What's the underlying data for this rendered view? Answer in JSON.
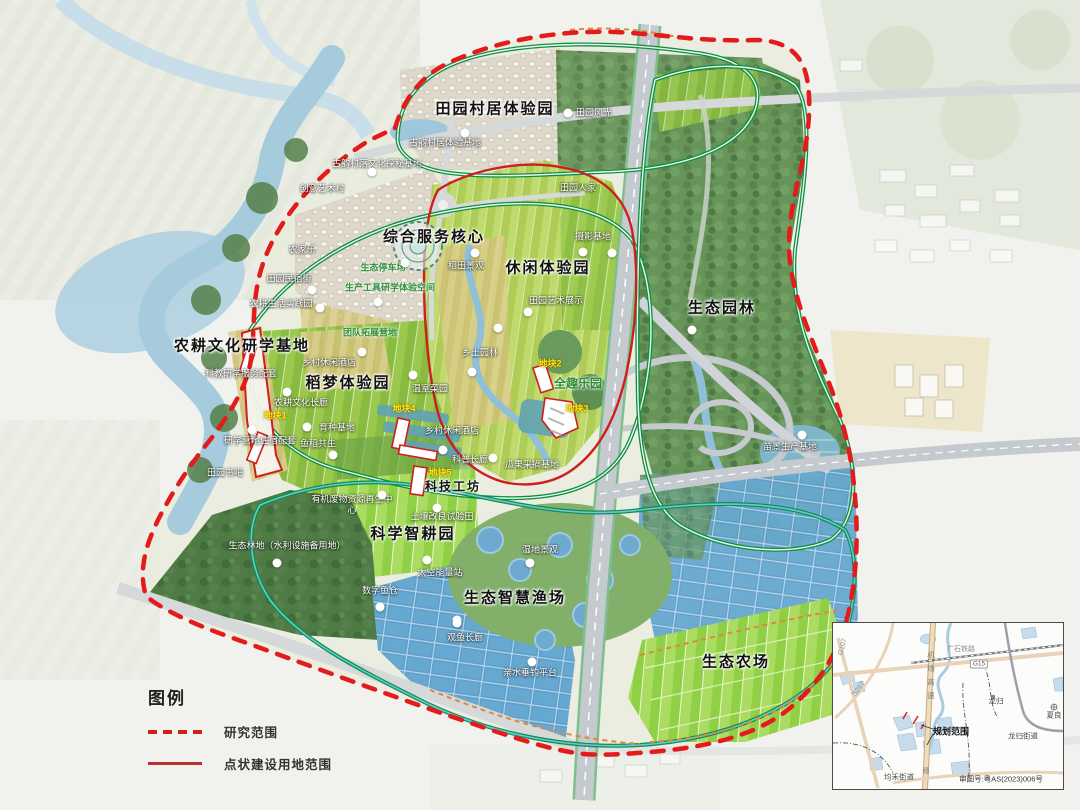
{
  "colors": {
    "boundary_red": "#e31b1b",
    "construction_red": "#cc1f1f",
    "greenway_green": "#0f8f43",
    "trail_orange": "#e0873a",
    "water_blue": "#a6cbdd",
    "plot_yellow": "#ffe600"
  },
  "map": {
    "zone_labels": [
      {
        "t": "田园村居体验园",
        "x": 495,
        "y": 108
      },
      {
        "t": "综合服务核心",
        "x": 434,
        "y": 236
      },
      {
        "t": "休闲体验园",
        "x": 548,
        "y": 267
      },
      {
        "t": "生态园林",
        "x": 722,
        "y": 307
      },
      {
        "t": "农耕文化研学基地",
        "x": 242,
        "y": 345
      },
      {
        "t": "稻梦体验园",
        "x": 348,
        "y": 382
      },
      {
        "t": "科学智耕园",
        "x": 413,
        "y": 533
      },
      {
        "t": "科技工坊",
        "x": 453,
        "y": 486,
        "fs": 12
      },
      {
        "t": "生态智慧渔场",
        "x": 515,
        "y": 597
      },
      {
        "t": "生态农场",
        "x": 736,
        "y": 661
      }
    ],
    "poi_labels": [
      {
        "t": "田园风光",
        "x": 594,
        "y": 112
      },
      {
        "t": "古韵村居体验基地",
        "x": 445,
        "y": 142
      },
      {
        "t": "古韵村落文化探秘基地",
        "x": 377,
        "y": 163
      },
      {
        "t": "创意艺术村",
        "x": 322,
        "y": 188
      },
      {
        "t": "农家乐",
        "x": 302,
        "y": 249
      },
      {
        "t": "田园民宿街",
        "x": 289,
        "y": 278
      },
      {
        "t": "农耕生活实践园",
        "x": 281,
        "y": 303
      },
      {
        "t": "田园人家",
        "x": 578,
        "y": 187
      },
      {
        "t": "摄影基地",
        "x": 593,
        "y": 236
      },
      {
        "t": "稻田景观",
        "x": 466,
        "y": 265
      },
      {
        "t": "田园艺术展示",
        "x": 556,
        "y": 300
      },
      {
        "t": "乡土园林",
        "x": 480,
        "y": 352
      },
      {
        "t": "科教研学服务配套",
        "x": 241,
        "y": 373
      },
      {
        "t": "乡村休闲酒店",
        "x": 329,
        "y": 362
      },
      {
        "t": "乡村休闲酒店",
        "x": 452,
        "y": 430
      },
      {
        "t": "农耕文化长廊",
        "x": 301,
        "y": 402
      },
      {
        "t": "育种基地",
        "x": 337,
        "y": 427
      },
      {
        "t": "鱼稻共生",
        "x": 318,
        "y": 443
      },
      {
        "t": "研学营地住宿配套",
        "x": 260,
        "y": 440
      },
      {
        "t": "田园书吧",
        "x": 225,
        "y": 472
      },
      {
        "t": "温室菜园",
        "x": 430,
        "y": 388
      },
      {
        "t": "科普长廊",
        "x": 470,
        "y": 459
      },
      {
        "t": "瓜果采摘基地",
        "x": 532,
        "y": 464
      },
      {
        "t": "土壤改良试验田",
        "x": 442,
        "y": 516
      },
      {
        "t": "有机废物资源再生中心",
        "x": 352,
        "y": 505,
        "w": 86
      },
      {
        "t": "生态林地（水利设施备用地）",
        "x": 287,
        "y": 546,
        "w": 150
      },
      {
        "t": "太空能量站",
        "x": 440,
        "y": 572
      },
      {
        "t": "数字鱼仓",
        "x": 380,
        "y": 590
      },
      {
        "t": "湿地景观",
        "x": 540,
        "y": 549
      },
      {
        "t": "观鱼长廊",
        "x": 465,
        "y": 637
      },
      {
        "t": "亲水垂钓平台",
        "x": 530,
        "y": 672
      },
      {
        "t": "苗景生产基地",
        "x": 790,
        "y": 446
      }
    ],
    "green_labels": [
      {
        "t": "生态停车场",
        "x": 383,
        "y": 267
      },
      {
        "t": "生产工具研学体验空间",
        "x": 390,
        "y": 287
      },
      {
        "t": "团队拓展营地",
        "x": 370,
        "y": 332
      },
      {
        "t": "全趣乐园",
        "x": 578,
        "y": 383,
        "fs": 12
      }
    ],
    "plot_labels": [
      {
        "t": "地块1",
        "x": 275,
        "y": 415
      },
      {
        "t": "地块2",
        "x": 550,
        "y": 363
      },
      {
        "t": "地块3",
        "x": 577,
        "y": 408
      },
      {
        "t": "地块4",
        "x": 404,
        "y": 408
      },
      {
        "t": "地块5",
        "x": 440,
        "y": 472
      }
    ],
    "markers": [
      [
        568,
        113
      ],
      [
        465,
        133
      ],
      [
        372,
        172
      ],
      [
        405,
        263
      ],
      [
        312,
        290
      ],
      [
        378,
        302
      ],
      [
        320,
        308
      ],
      [
        475,
        253
      ],
      [
        583,
        252
      ],
      [
        612,
        253
      ],
      [
        528,
        312
      ],
      [
        498,
        328
      ],
      [
        472,
        372
      ],
      [
        362,
        352
      ],
      [
        287,
        392
      ],
      [
        307,
        427
      ],
      [
        333,
        455
      ],
      [
        252,
        430
      ],
      [
        413,
        375
      ],
      [
        443,
        450
      ],
      [
        493,
        458
      ],
      [
        382,
        495
      ],
      [
        437,
        508
      ],
      [
        427,
        560
      ],
      [
        530,
        563
      ],
      [
        380,
        607
      ],
      [
        457,
        620
      ],
      [
        277,
        563
      ],
      [
        457,
        623
      ],
      [
        532,
        662
      ],
      [
        802,
        435
      ],
      [
        692,
        330
      ]
    ]
  },
  "legend": {
    "title": "图例",
    "items": [
      {
        "label": "研究范围",
        "style": "dashed"
      },
      {
        "label": "点状建设用地范围",
        "style": "solid"
      }
    ]
  },
  "inset": {
    "labels": [
      {
        "t": "广石铁路",
        "x": 128,
        "y": 26,
        "cls": "ins-road"
      },
      {
        "t": "G15",
        "x": 146,
        "y": 41,
        "cls": "ins-badge"
      },
      {
        "t": "G107",
        "x": 10,
        "y": 24,
        "cls": "ins-road",
        "rot": -75
      },
      {
        "t": "S267",
        "x": 26,
        "y": 66,
        "cls": "ins-road",
        "rot": -55
      },
      {
        "t": "机场高速",
        "x": 98,
        "y": 55,
        "cls": "ins-vert"
      },
      {
        "t": "穗",
        "x": 93,
        "y": 148,
        "cls": "ins-road"
      },
      {
        "t": "龙归",
        "x": 163,
        "y": 78,
        "cls": "ins-town"
      },
      {
        "t": "龙归街道",
        "x": 190,
        "y": 113,
        "cls": "ins-town"
      },
      {
        "t": "夏良",
        "x": 221,
        "y": 92,
        "cls": "ins-town"
      },
      {
        "t": "规划范围",
        "x": 118,
        "y": 108,
        "cls": "ins-bold"
      },
      {
        "t": "均禾街道",
        "x": 66,
        "y": 154,
        "cls": "ins-town"
      },
      {
        "t": "审图号:粤AS(2023)006号",
        "x": 168,
        "y": 156,
        "cls": "ins-approval"
      }
    ]
  }
}
